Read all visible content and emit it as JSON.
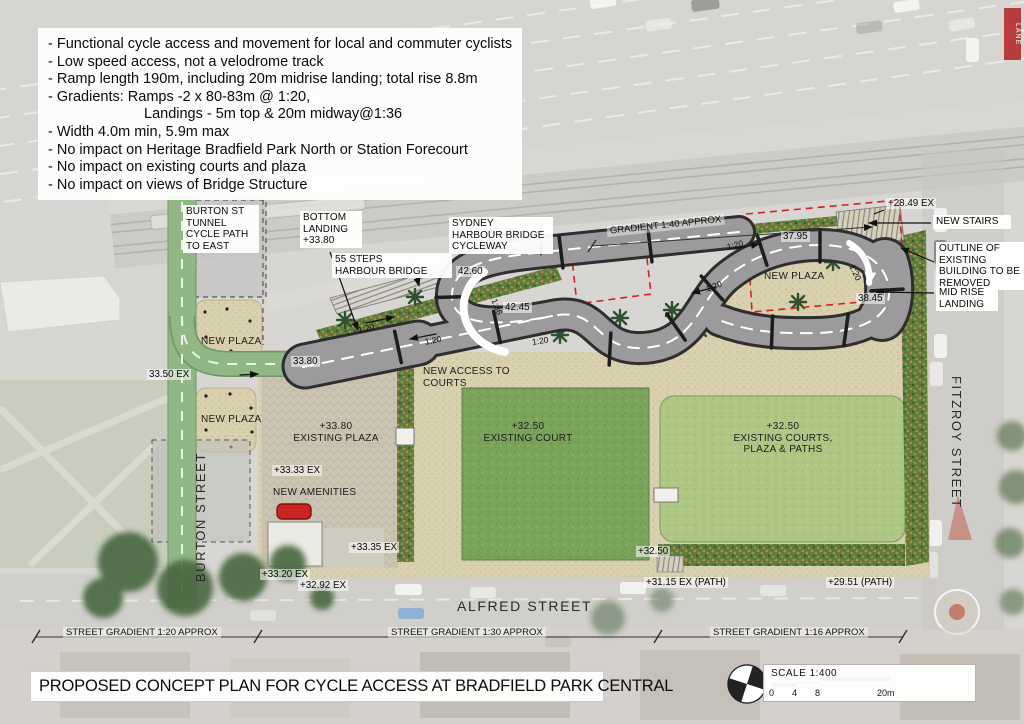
{
  "title": "PROPOSED CONCEPT PLAN FOR CYCLE ACCESS AT BRADFIELD PARK CENTRAL",
  "notes": {
    "lines": [
      "- Functional cycle access and movement for local and commuter cyclists",
      "- Low speed access, not a velodrome track",
      "- Ramp length 190m, including 20m midrise landing; total rise 8.8m",
      "- Gradients: Ramps -2 x 80-83m @ 1:20,",
      "Landings - 5m top & 20m midway@1:36",
      "- Width 4.0m min, 5.9m max",
      "- No impact on Heritage Bradfield Park North or Station Forecourt",
      "- No impact on existing courts and plaza",
      "- No impact on views of Bridge Structure"
    ]
  },
  "callouts": {
    "burton_tunnel": "BURTON ST\nTUNNEL\nCYCLE PATH\nTO EAST",
    "bottom_landing": "BOTTOM\nLANDING\n+33.80",
    "steps_55": "55 STEPS\nHARBOUR BRIDGE",
    "shb_cycleway": "SYDNEY\nHARBOUR BRIDGE\nCYCLEWAY",
    "new_stairs": "NEW STAIRS",
    "outline_removed": "OUTLINE OF\nEXISTING\nBUILDING TO BE\nREMOVED",
    "midrise_landing": "MID RISE\nLANDING"
  },
  "areas": {
    "new_plaza_1": "NEW PLAZA",
    "new_plaza_2": "NEW PLAZA",
    "new_plaza_loop": "NEW PLAZA",
    "new_access": "NEW ACCESS TO\nCOURTS",
    "new_amenities": "NEW AMENITIES",
    "existing_plaza": "+33.80\nEXISTING PLAZA",
    "existing_court": "+32.50\nEXISTING COURT",
    "existing_courts2": "+32.50\nEXISTING COURTS,\nPLAZA & PATHS"
  },
  "elevations": {
    "e4260": "42.60",
    "e4245": "42.45",
    "e3795": "37.95",
    "e3845": "38.45",
    "e3380": "33.80",
    "e2849": "+28.49 EX",
    "e3350": "33.50 EX",
    "e3333": "+33.33 EX",
    "e3335": "+33.35 EX",
    "e3320": "+33.20 EX",
    "e3292": "+32.92 EX",
    "e3250": "+32.50",
    "e3115": "+31.15 EX (PATH)",
    "e2951": "+29.51 (PATH)"
  },
  "slopes": {
    "s1": "1:20",
    "s2": "1:20",
    "s3": "1:20",
    "s4": "1:20",
    "s5": "1:20",
    "s6": "1:20",
    "s7": "1:36",
    "grad40": "GRADIENT 1:40 APPROX"
  },
  "streets": {
    "alfred": "ALFRED STREET",
    "fitzroy": "FITZROY STREET",
    "burton": "BURTON STREET"
  },
  "dims": {
    "d1": "STREET GRADIENT 1:20 APPROX",
    "d2": "STREET GRADIENT 1:30 APPROX",
    "d3": "STREET GRADIENT 1:16 APPROX"
  },
  "scale": {
    "label": "SCALE  1:400",
    "ticks": [
      "0",
      "4",
      "8",
      "20m"
    ]
  },
  "misc": {
    "lane_sign": "LANE"
  }
}
